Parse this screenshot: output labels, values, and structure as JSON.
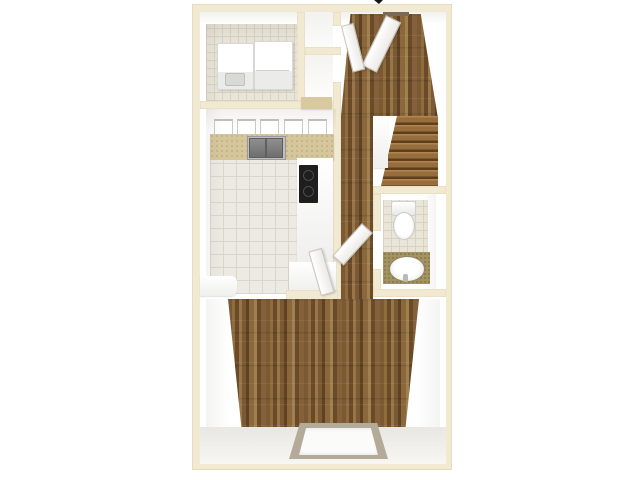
{
  "scene": {
    "type": "3d-top-down-floor-plan-render",
    "background_color": "#ffffff",
    "text_visible": "",
    "top_edge_artifact": "tiny cropped black mark at top center"
  },
  "palette": {
    "wall_top": "#f1e9d2",
    "wall_face": "#ffffff",
    "tile_kitchen": "#edeae3",
    "tile_grout": "#dbd6cc",
    "counter_tan": "#d5c69c",
    "vanity_olive": "#a39360",
    "wood_mid": "#7b5a33",
    "stair_wood": "#966d3c",
    "cooktop_black": "#1e1e1e",
    "sink_gray": "#8f8f8f",
    "window_frame": "#b3aa99",
    "window_pane": "#fbfbf9"
  },
  "rooms": [
    {
      "id": "laundry",
      "label": "laundry closet",
      "floor": "light tile",
      "fixtures": [
        "washer",
        "dryer"
      ]
    },
    {
      "id": "storage-closets",
      "label": "closet nooks beside laundry",
      "floor": "white",
      "fixtures": [
        "tan threshold"
      ]
    },
    {
      "id": "kitchen",
      "label": "kitchen",
      "floor": "white tile",
      "fixtures": [
        "upper cabinets",
        "tan counter",
        "double sink",
        "peninsula counter",
        "black cooktop"
      ]
    },
    {
      "id": "entry-hall",
      "label": "entry hall",
      "floor": "hardwood",
      "fixtures": [
        "open front door",
        "side door"
      ]
    },
    {
      "id": "staircase",
      "label": "staircase going up",
      "floor": "wood steps",
      "fixtures": [
        "white stringer wall"
      ]
    },
    {
      "id": "bathroom",
      "label": "bathroom",
      "floor": "small tile",
      "fixtures": [
        "toilet",
        "vanity with oval sink",
        "open door"
      ]
    },
    {
      "id": "living-room",
      "label": "living room",
      "floor": "hardwood",
      "fixtures": [
        "window in bottom wall"
      ]
    }
  ]
}
